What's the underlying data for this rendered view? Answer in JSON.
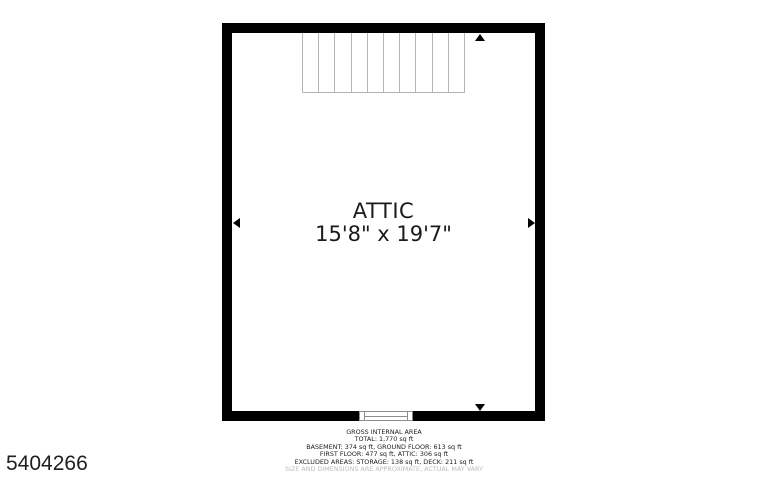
{
  "floorplan": {
    "room": {
      "name": "ATTIC",
      "dimensions": "15'8\" x 19'7\""
    },
    "stairs": {
      "treads": 10
    },
    "footer": {
      "heading": "GROSS INTERNAL AREA",
      "lines": [
        "TOTAL: 1,770 sq ft",
        "BASEMENT: 374 sq ft, GROUND FLOOR: 613 sq ft",
        "FIRST FLOOR: 477 sq ft, ATTIC: 306 sq ft",
        "EXCLUDED AREAS: STORAGE: 138 sq ft, DECK: 211 sq ft"
      ],
      "disclaimer": "SIZE AND DIMENSIONS ARE APPROXIMATE, ACTUAL MAY VARY"
    },
    "listing_id": "5404266",
    "colors": {
      "wall": "#000000",
      "stair_line": "#b5b5b5",
      "window_line": "#8d8d8d",
      "disclaimer_text": "#bcbcbc"
    }
  }
}
